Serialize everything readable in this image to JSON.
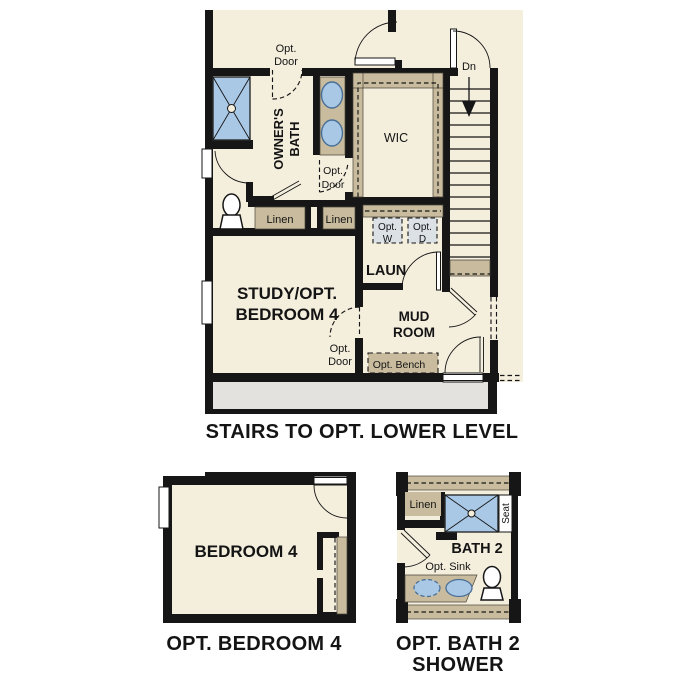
{
  "colors": {
    "wall": "#161616",
    "floor": "#f4eedd",
    "tan": "#c9bc9e",
    "blue": "#a9c8e6",
    "appliance": "#dce1e5",
    "lower_stairs": "#e4e2de",
    "text": "#141414"
  },
  "main_plan": {
    "caption": "STAIRS TO OPT. LOWER LEVEL",
    "rooms": {
      "owners_bath": {
        "line1": "OWNER'S",
        "line2": "BATH"
      },
      "wic": "WIC",
      "laundry": "LAUN",
      "study": {
        "line1": "STUDY/OPT.",
        "line2": "BEDROOM 4"
      },
      "mud_room": {
        "line1": "MUD",
        "line2": "ROOM"
      }
    },
    "labels": {
      "opt_door": {
        "line1": "Opt.",
        "line2": "Door"
      },
      "down": "Dn",
      "linen": "Linen",
      "opt_washer": {
        "line1": "Opt.",
        "line2": "W"
      },
      "opt_dryer": {
        "line1": "Opt.",
        "line2": "D"
      },
      "opt_bench": "Opt. Bench"
    }
  },
  "bedroom_plan": {
    "room": "BEDROOM 4",
    "caption": "OPT. BEDROOM 4"
  },
  "bath_plan": {
    "room": "BATH 2",
    "labels": {
      "linen": "Linen",
      "seat": "Seat",
      "opt_sink": "Opt. Sink"
    },
    "caption": {
      "line1": "OPT. BATH 2",
      "line2": "SHOWER"
    }
  }
}
